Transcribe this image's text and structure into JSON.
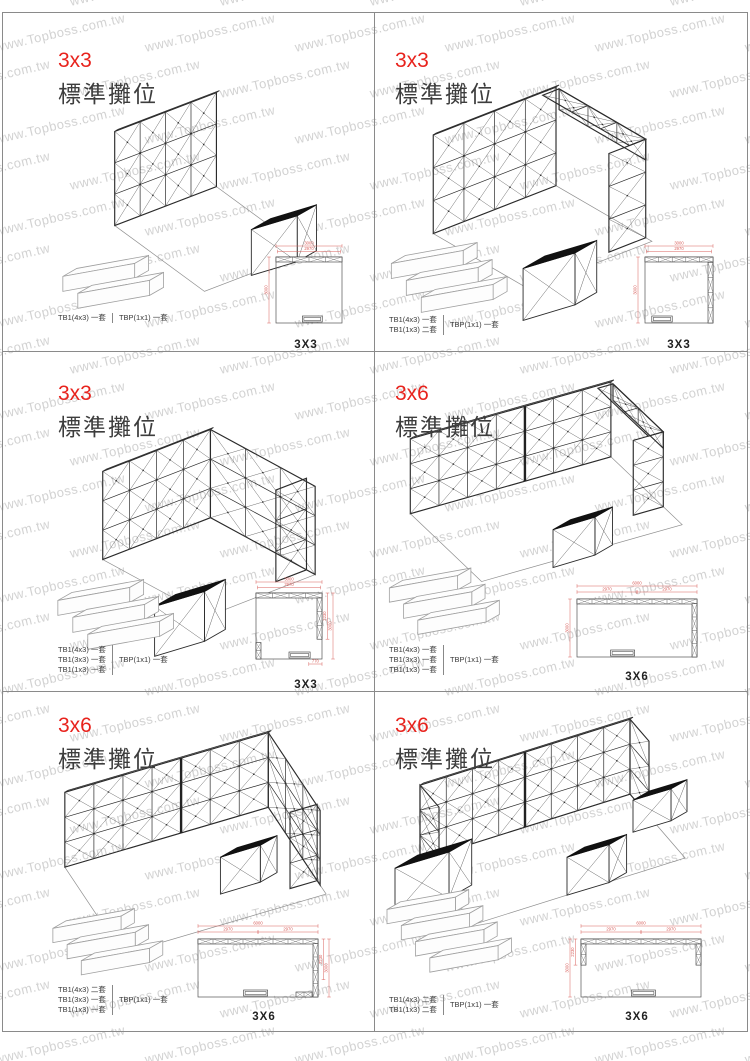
{
  "page": {
    "watermark_text": "www.Topboss.com.tw"
  },
  "colors": {
    "title_red": "#e8231d",
    "dim_red": "#d8605c",
    "wall_line": "#2b2b2b",
    "watermark_gray": "#c3c3c3"
  },
  "panels": [
    {
      "title": "3x3",
      "subtitle": "標準攤位",
      "parts_left": [
        "TB1(4x3) 一套"
      ],
      "parts_right": [
        "TBP(1x1) 一套"
      ],
      "plan_label": "3X3",
      "plan_dims": {
        "top": [
          "3000",
          "2970"
        ],
        "left": [
          "3000"
        ],
        "right": [],
        "bottom": []
      }
    },
    {
      "title": "3x3",
      "subtitle": "標準攤位",
      "parts_left": [
        "TB1(4x3) 一套",
        "TB1(1x3) 二套"
      ],
      "parts_right": [
        "TBP(1x1) 一套"
      ],
      "plan_label": "3X3",
      "plan_dims": {
        "top": [
          "3000",
          "2970"
        ],
        "left": [
          "3000"
        ],
        "right": [],
        "bottom": []
      }
    },
    {
      "title": "3x3",
      "subtitle": "標準攤位",
      "parts_left": [
        "TB1(4x3) 一套",
        "TB1(3x3) 一套",
        "TB1(1x3) 一套"
      ],
      "parts_right": [
        "TBP(1x1) 一套"
      ],
      "plan_label": "3X3",
      "plan_dims": {
        "top": [
          "3000",
          "2970"
        ],
        "left": [],
        "right": [
          "2230",
          "3000"
        ],
        "bottom": [
          "770"
        ]
      }
    },
    {
      "title": "3x6",
      "subtitle": "標準攤位",
      "parts_left": [
        "TB1(4x3) 一套",
        "TB1(3x3) 一套",
        "TB1(1x3) 一套"
      ],
      "parts_right": [
        "TBP(1x1) 一套"
      ],
      "plan_label": "3X6",
      "plan_dims": {
        "top": [
          "6000",
          "2970",
          "2970"
        ],
        "left": [
          "3000"
        ],
        "right": [],
        "bottom": []
      }
    },
    {
      "title": "3x6",
      "subtitle": "標準攤位",
      "parts_left": [
        "TB1(4x3) 二套",
        "TB1(3x3) 一套",
        "TB1(1x3) 一套"
      ],
      "parts_right": [
        "TBP(1x1) 一套"
      ],
      "plan_label": "3X6",
      "plan_dims": {
        "top": [
          "6000",
          "2970",
          "2970"
        ],
        "left": [],
        "right": [
          "2230",
          "3000"
        ],
        "bottom": []
      }
    },
    {
      "title": "3x6",
      "subtitle": "標準攤位",
      "parts_left": [
        "TB1(4x3) 二套",
        "TB1(1x3) 二套"
      ],
      "parts_right": [
        "TBP(1x1) 一套"
      ],
      "plan_label": "3X6",
      "plan_dims": {
        "top": [
          "6000",
          "2970",
          "2970"
        ],
        "left": [
          "2230",
          "3000"
        ],
        "right": [],
        "bottom": []
      }
    }
  ]
}
